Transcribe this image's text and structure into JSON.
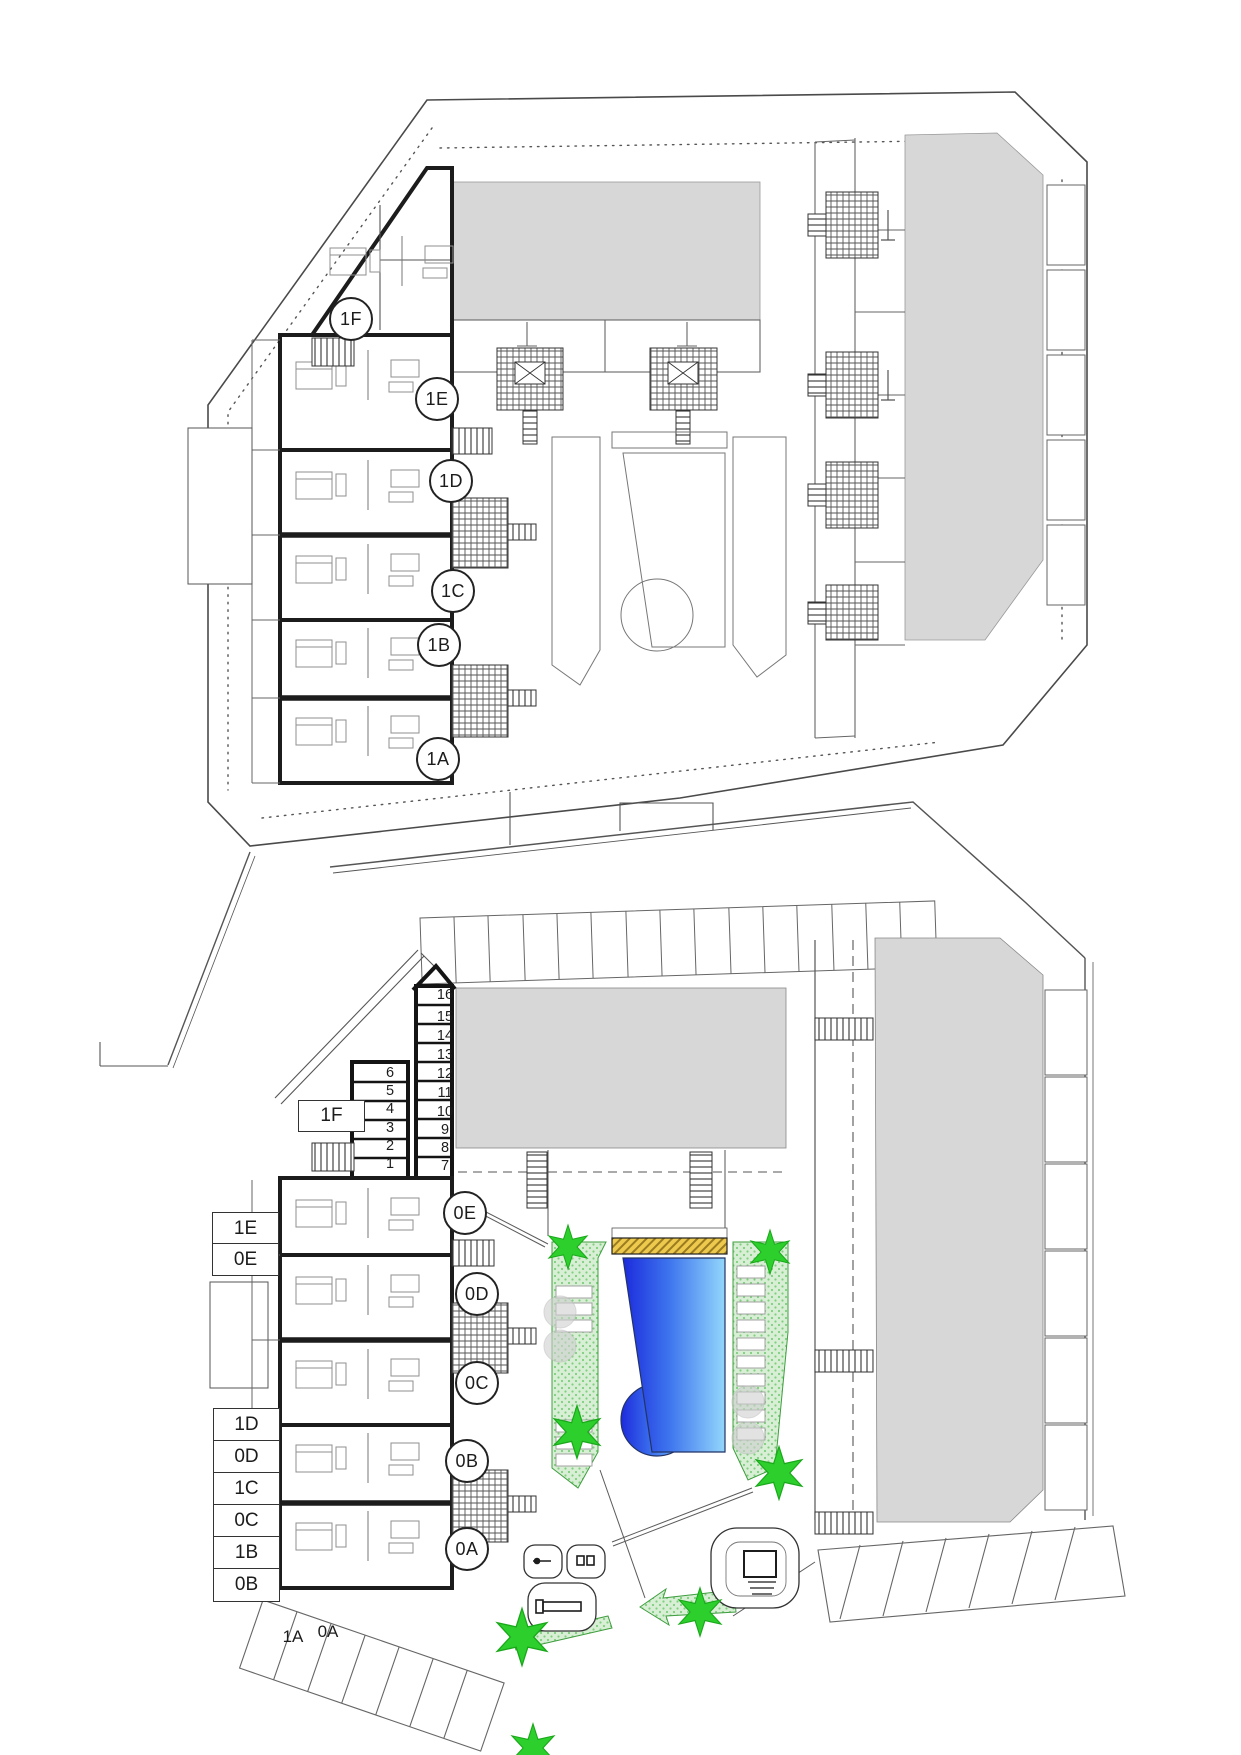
{
  "plans": {
    "upper": {
      "unit_circles": [
        {
          "id": "1F"
        },
        {
          "id": "1E"
        },
        {
          "id": "1D"
        },
        {
          "id": "1C"
        },
        {
          "id": "1B"
        },
        {
          "id": "1A"
        }
      ]
    },
    "lower": {
      "unit_circles": [
        {
          "id": "0E"
        },
        {
          "id": "0D"
        },
        {
          "id": "0C"
        },
        {
          "id": "0B"
        },
        {
          "id": "0A"
        }
      ],
      "storage_right": [
        "16",
        "15",
        "14",
        "13",
        "12",
        "11",
        "10",
        "9",
        "8",
        "7"
      ],
      "storage_left": [
        "6",
        "5",
        "4",
        "3",
        "2",
        "1"
      ],
      "assignment_boxes": [
        "1F",
        "1E",
        "0E",
        "1D",
        "0D",
        "1C",
        "0C",
        "1B",
        "0B"
      ],
      "parking_labels": [
        "1A",
        "0A"
      ]
    }
  },
  "colors": {
    "roof_gray": "#d7d7d7",
    "pool_dark": "#1c2bdc",
    "pool_mid": "#3d74ee",
    "pool_light": "#93d6fb",
    "deck_gold": "#edc94d",
    "landscape_green": "#d8efd6",
    "tree_green": "#2ccf2c"
  }
}
